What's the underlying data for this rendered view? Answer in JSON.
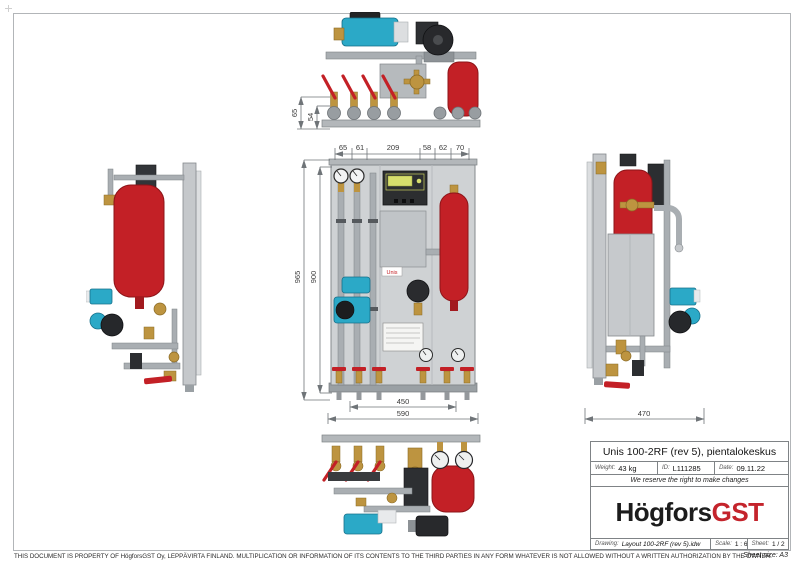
{
  "page": {
    "disclaimer": "THIS DOCUMENT IS PROPERTY OF HögforsGST Oy, LEPPÄVIRTA FINLAND. MULTIPLICATION OR INFORMATION OF ITS CONTENTS TO THE THIRD PARTIES IN ANY FORM WHATEVER IS NOT ALLOWED WITHOUT A WRITTEN AUTHORIZATION BY THE OWNER.",
    "sheet_size_note": "Sheet size: A3"
  },
  "title_block": {
    "title": "Unis 100-2RF (rev 5), pientalokeskus",
    "weight_label": "Weight:",
    "weight_value": "43 kg",
    "id_label": "ID:",
    "id_value": "L111285",
    "date_label": "Date:",
    "date_value": "09.11.22",
    "notice": "We reserve the right to make changes",
    "logo": {
      "black": "Högfors",
      "red": "GST"
    },
    "drawing_label": "Drawing:",
    "drawing_value": "Layout 100-2RF (rev 5).idw",
    "scale_label": "Scale:",
    "scale_value": "1 : 6",
    "sheet_label": "Sheet:",
    "sheet_value": "1 / 2"
  },
  "dimensions": {
    "top_view": {
      "left_outer": "65",
      "left_inner": "54",
      "bottom_chain": [
        "65",
        "61",
        "209",
        "58",
        "62",
        "70"
      ]
    },
    "front_view": {
      "height_outer": "965",
      "height_inner": "900",
      "width_inner": "450",
      "width_outer": "590"
    },
    "right_view": {
      "width": "470"
    }
  },
  "front_view": {
    "sticker": "Unis"
  },
  "colors": {
    "vessel_red": "#c32026",
    "pump_teal": "#2ba9c7",
    "brass": "#bd9440",
    "logo_red": "#c4242c",
    "panel_gray": "#cfd2d4",
    "dimension_gray": "#6f7478"
  }
}
